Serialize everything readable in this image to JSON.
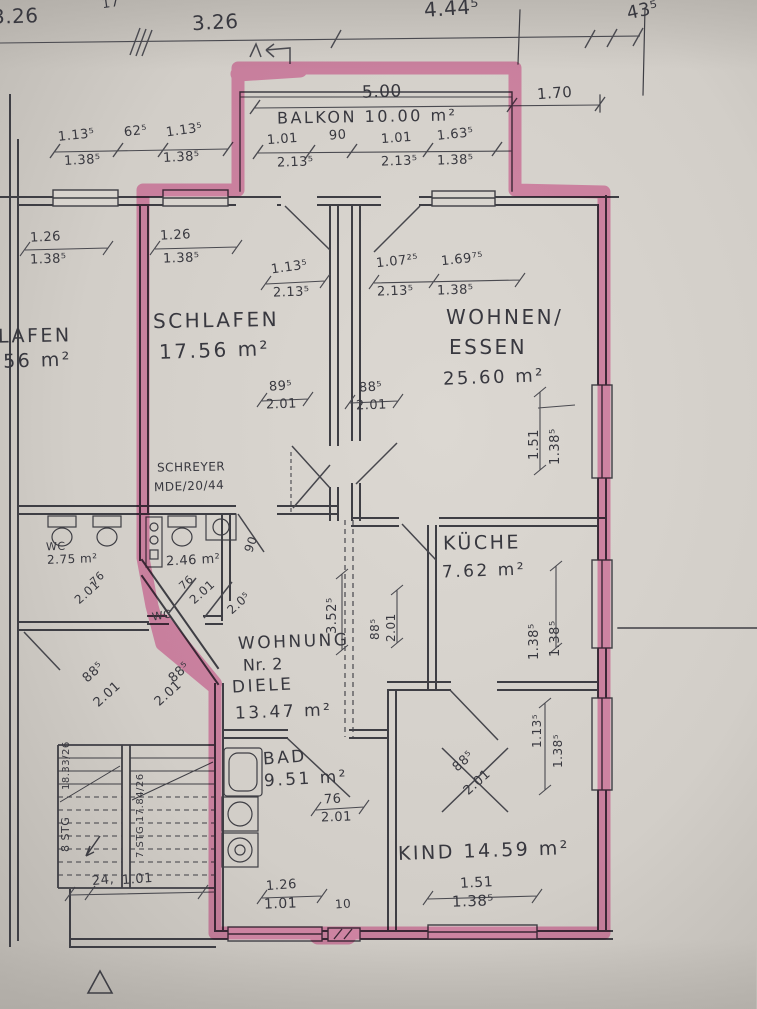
{
  "document": {
    "kind_label": "floor plan scan",
    "apartment_label": "WOHNUNG Nr. 2",
    "highlight_color": "#e8559f",
    "paper_color": "#d4d0ca",
    "ink_color": "#3e3e44"
  },
  "labels": [
    {
      "name": "dim-top-left-326",
      "text": "3.26",
      "x": -8,
      "y": 6,
      "size": 20,
      "rot": -2
    },
    {
      "name": "dim-top-17",
      "text": "17",
      "x": 102,
      "y": -3,
      "size": 13,
      "rot": -8
    },
    {
      "name": "dim-top-326",
      "text": "3.26",
      "x": 192,
      "y": 12,
      "size": 20,
      "rot": -3
    },
    {
      "name": "dim-top-4445",
      "text": "4.44⁵",
      "x": 424,
      "y": -2,
      "size": 20,
      "rot": -4
    },
    {
      "name": "dim-top-435",
      "text": "43⁵",
      "x": 627,
      "y": 2,
      "size": 18,
      "rot": -12
    },
    {
      "name": "dim-balkon-500",
      "text": "5.00",
      "x": 362,
      "y": 84,
      "size": 17,
      "rot": -2
    },
    {
      "name": "dim-170",
      "text": "1.70",
      "x": 537,
      "y": 86,
      "size": 15,
      "rot": -4
    },
    {
      "name": "room-balkon",
      "text": "BALKON 10.00 m²",
      "x": 277,
      "y": 109,
      "size": 16,
      "rot": -1,
      "cls": "big"
    },
    {
      "name": "dim-balkon-101a",
      "text": "1.01",
      "x": 267,
      "y": 133,
      "size": 13,
      "rot": -4
    },
    {
      "name": "dim-balkon-90",
      "text": "90",
      "x": 329,
      "y": 129,
      "size": 13,
      "rot": -4
    },
    {
      "name": "dim-balkon-101b",
      "text": "1.01",
      "x": 381,
      "y": 132,
      "size": 13,
      "rot": -4
    },
    {
      "name": "dim-balkon-1635",
      "text": "1.63⁵",
      "x": 437,
      "y": 128,
      "size": 13,
      "rot": -6
    },
    {
      "name": "dim-balkon-2135a",
      "text": "2.13⁵",
      "x": 277,
      "y": 156,
      "size": 13,
      "rot": -2
    },
    {
      "name": "dim-balkon-2135b",
      "text": "2.13⁵",
      "x": 381,
      "y": 155,
      "size": 13,
      "rot": -2
    },
    {
      "name": "dim-balkon-1385",
      "text": "1.38⁵",
      "x": 437,
      "y": 154,
      "size": 13,
      "rot": -2
    },
    {
      "name": "dim-nb-1135a",
      "text": "1.13⁵",
      "x": 58,
      "y": 129,
      "size": 13,
      "rot": -6
    },
    {
      "name": "dim-nb-625",
      "text": "62⁵",
      "x": 124,
      "y": 125,
      "size": 13,
      "rot": -6
    },
    {
      "name": "dim-nb-1135b",
      "text": "1.13⁵",
      "x": 166,
      "y": 124,
      "size": 13,
      "rot": -8
    },
    {
      "name": "dim-nb-1385a",
      "text": "1.38⁵",
      "x": 64,
      "y": 154,
      "size": 13,
      "rot": -3
    },
    {
      "name": "dim-nb-1385b",
      "text": "1.38⁵",
      "x": 163,
      "y": 151,
      "size": 13,
      "rot": -3
    },
    {
      "name": "dim-nbl-126",
      "text": "1.26",
      "x": 30,
      "y": 231,
      "size": 13,
      "rot": -3
    },
    {
      "name": "dim-nbl-1385",
      "text": "1.38⁵",
      "x": 30,
      "y": 253,
      "size": 13,
      "rot": -2
    },
    {
      "name": "dim-schlafen-126",
      "text": "1.26",
      "x": 160,
      "y": 229,
      "size": 13,
      "rot": -3
    },
    {
      "name": "dim-schlafen-1385",
      "text": "1.38⁵",
      "x": 163,
      "y": 252,
      "size": 13,
      "rot": -2
    },
    {
      "name": "dim-schlafen-1135",
      "text": "1.13⁵",
      "x": 271,
      "y": 261,
      "size": 13,
      "rot": -8
    },
    {
      "name": "dim-schlafen-2135",
      "text": "2.13⁵",
      "x": 273,
      "y": 286,
      "size": 13,
      "rot": -2
    },
    {
      "name": "room-schlafen-name",
      "text": "SCHLAFEN",
      "x": 153,
      "y": 310,
      "size": 20,
      "rot": -1,
      "cls": "big"
    },
    {
      "name": "room-schlafen-area",
      "text": "17.56 m²",
      "x": 159,
      "y": 340,
      "size": 20,
      "rot": -2,
      "cls": "big"
    },
    {
      "name": "dim-door-895",
      "text": "89⁵",
      "x": 269,
      "y": 380,
      "size": 13,
      "rot": -4
    },
    {
      "name": "dim-door-895-h",
      "text": "2.01",
      "x": 266,
      "y": 398,
      "size": 13,
      "rot": -2
    },
    {
      "name": "dim-door-885",
      "text": "88⁵",
      "x": 359,
      "y": 381,
      "size": 13,
      "rot": -4
    },
    {
      "name": "dim-door-885-h",
      "text": "2.01",
      "x": 356,
      "y": 399,
      "size": 13,
      "rot": -2
    },
    {
      "name": "dim-wohnen-10725",
      "text": "1.07²⁵",
      "x": 376,
      "y": 255,
      "size": 13,
      "rot": -6
    },
    {
      "name": "dim-wohnen-16975",
      "text": "1.69⁷⁵",
      "x": 441,
      "y": 253,
      "size": 13,
      "rot": -6
    },
    {
      "name": "dim-wohnen-2135",
      "text": "2.13⁵",
      "x": 377,
      "y": 285,
      "size": 13,
      "rot": -2
    },
    {
      "name": "dim-wohnen-1385",
      "text": "1.38⁵",
      "x": 437,
      "y": 284,
      "size": 13,
      "rot": -2
    },
    {
      "name": "room-wohnen-name-1",
      "text": "WOHNEN/",
      "x": 446,
      "y": 307,
      "size": 20,
      "rot": 0,
      "cls": "big"
    },
    {
      "name": "room-wohnen-name-2",
      "text": "ESSEN",
      "x": 449,
      "y": 337,
      "size": 20,
      "rot": 0,
      "cls": "big"
    },
    {
      "name": "room-wohnen-area",
      "text": "25.60 m²",
      "x": 443,
      "y": 369,
      "size": 18,
      "rot": -2,
      "cls": "big"
    },
    {
      "name": "dim-wohnen-151-v",
      "text": "1.51",
      "x": 528,
      "y": 460,
      "size": 13,
      "rot": -90
    },
    {
      "name": "dim-wohnen-1385-v",
      "text": "1.38⁵",
      "x": 549,
      "y": 465,
      "size": 13,
      "rot": -90
    },
    {
      "name": "note-schreyer",
      "text": "SCHREYER",
      "x": 157,
      "y": 461,
      "size": 12,
      "rot": -1
    },
    {
      "name": "note-ref",
      "text": "MDE/20/44",
      "x": 154,
      "y": 480,
      "size": 12,
      "rot": -2
    },
    {
      "name": "room-kueche-name",
      "text": "KÜCHE",
      "x": 443,
      "y": 534,
      "size": 19,
      "rot": -1,
      "cls": "big"
    },
    {
      "name": "room-kueche-area",
      "text": "7.62 m²",
      "x": 442,
      "y": 563,
      "size": 17,
      "rot": -2,
      "cls": "big"
    },
    {
      "name": "dim-kueche-1385a-v",
      "text": "1.38⁵",
      "x": 528,
      "y": 660,
      "size": 13,
      "rot": -90
    },
    {
      "name": "dim-kueche-1385b-v",
      "text": "1.38⁵",
      "x": 549,
      "y": 657,
      "size": 13,
      "rot": -90
    },
    {
      "name": "dim-hall-3525-v",
      "text": "3.52⁵",
      "x": 326,
      "y": 634,
      "size": 13,
      "rot": -90
    },
    {
      "name": "dim-hall-885-v",
      "text": "88⁵",
      "x": 369,
      "y": 640,
      "size": 12,
      "rot": -90
    },
    {
      "name": "dim-hall-201-v",
      "text": "2.01",
      "x": 385,
      "y": 642,
      "size": 12,
      "rot": -90
    },
    {
      "name": "dim-door-90",
      "text": "90",
      "x": 243,
      "y": 538,
      "size": 12,
      "rot": -70
    },
    {
      "name": "label-wc-neighbor",
      "text": "WC",
      "x": 46,
      "y": 541,
      "size": 11,
      "rot": -2
    },
    {
      "name": "area-wc-neighbor",
      "text": "2.75 m²",
      "x": 47,
      "y": 553,
      "size": 12,
      "rot": -2
    },
    {
      "name": "dim-wcnb-76",
      "text": "76",
      "x": 90,
      "y": 573,
      "size": 11,
      "rot": -42
    },
    {
      "name": "dim-wcnb-201",
      "text": "2.01",
      "x": 73,
      "y": 586,
      "size": 12,
      "rot": -42
    },
    {
      "name": "area-wc-apartment",
      "text": "2.46 m²",
      "x": 166,
      "y": 554,
      "size": 13,
      "rot": -3
    },
    {
      "name": "dim-wcap-76",
      "text": "76",
      "x": 179,
      "y": 577,
      "size": 11,
      "rot": -42
    },
    {
      "name": "dim-wcap-201",
      "text": "2.01",
      "x": 188,
      "y": 586,
      "size": 12,
      "rot": -42
    },
    {
      "name": "dim-wcap-205",
      "text": "2.0⁵",
      "x": 226,
      "y": 597,
      "size": 12,
      "rot": -42
    },
    {
      "name": "label-wc-apartment",
      "text": "WC",
      "x": 152,
      "y": 610,
      "size": 11,
      "rot": -10
    },
    {
      "name": "label-wohnung-1",
      "text": "WOHNUNG",
      "x": 238,
      "y": 634,
      "size": 17,
      "rot": -2,
      "cls": "big"
    },
    {
      "name": "label-wohnung-2",
      "text": "Nr. 2",
      "x": 243,
      "y": 657,
      "size": 16,
      "rot": -2
    },
    {
      "name": "dim-diele-885",
      "text": "88⁵",
      "x": 168,
      "y": 666,
      "size": 13,
      "rot": -42
    },
    {
      "name": "dim-diele-201",
      "text": "2.01",
      "x": 153,
      "y": 687,
      "size": 13,
      "rot": -42
    },
    {
      "name": "room-diele-name",
      "text": "DIELE",
      "x": 232,
      "y": 678,
      "size": 17,
      "rot": -3,
      "cls": "big"
    },
    {
      "name": "room-diele-area",
      "text": "13.47 m²",
      "x": 235,
      "y": 704,
      "size": 17,
      "rot": -2,
      "cls": "big"
    },
    {
      "name": "dim-stair-885",
      "text": "88⁵",
      "x": 82,
      "y": 666,
      "size": 13,
      "rot": -42
    },
    {
      "name": "dim-stair-201",
      "text": "2.01",
      "x": 92,
      "y": 688,
      "size": 13,
      "rot": -42
    },
    {
      "name": "stair-left-steigung",
      "text": "18.33/26",
      "x": 62,
      "y": 790,
      "size": 10,
      "rot": -90
    },
    {
      "name": "stair-left-stg",
      "text": "8 STG",
      "x": 60,
      "y": 852,
      "size": 11,
      "rot": -90
    },
    {
      "name": "stair-right-stg",
      "text": "7 STG 17.84/26",
      "x": 136,
      "y": 858,
      "size": 10,
      "rot": -90
    },
    {
      "name": "dim-24",
      "text": "24,",
      "x": 92,
      "y": 874,
      "size": 13,
      "rot": -6
    },
    {
      "name": "dim-101-stair",
      "text": "1.01",
      "x": 122,
      "y": 873,
      "size": 13,
      "rot": -4
    },
    {
      "name": "room-bad-name",
      "text": "BAD",
      "x": 263,
      "y": 750,
      "size": 17,
      "rot": -4,
      "cls": "big"
    },
    {
      "name": "room-bad-area",
      "text": "9.51 m²",
      "x": 264,
      "y": 771,
      "size": 17,
      "rot": -3,
      "cls": "big"
    },
    {
      "name": "dim-bad-76",
      "text": "76",
      "x": 324,
      "y": 793,
      "size": 13,
      "rot": -3
    },
    {
      "name": "dim-bad-201",
      "text": "2.01",
      "x": 321,
      "y": 811,
      "size": 13,
      "rot": -2
    },
    {
      "name": "dim-kind-885",
      "text": "88⁵",
      "x": 452,
      "y": 755,
      "size": 13,
      "rot": -42
    },
    {
      "name": "dim-kind-201",
      "text": "2.01",
      "x": 462,
      "y": 776,
      "size": 13,
      "rot": -42
    },
    {
      "name": "room-kind-name",
      "text": "KIND 14.59 m²",
      "x": 398,
      "y": 842,
      "size": 19,
      "rot": -2,
      "cls": "big"
    },
    {
      "name": "dim-kind-151",
      "text": "1.51",
      "x": 460,
      "y": 876,
      "size": 14,
      "rot": -3
    },
    {
      "name": "dim-kind-1385",
      "text": "1.38⁵",
      "x": 452,
      "y": 894,
      "size": 15,
      "rot": -2
    },
    {
      "name": "dim-kind-1135-v",
      "text": "1.13⁵",
      "x": 531,
      "y": 748,
      "size": 12,
      "rot": -90
    },
    {
      "name": "dim-kind-1385-v",
      "text": "1.38⁵",
      "x": 552,
      "y": 768,
      "size": 12,
      "rot": -90
    },
    {
      "name": "dim-bottom-126",
      "text": "1.26",
      "x": 266,
      "y": 879,
      "size": 13,
      "rot": -4
    },
    {
      "name": "dim-bottom-101",
      "text": "1.01",
      "x": 264,
      "y": 897,
      "size": 14,
      "rot": -2
    },
    {
      "name": "dim-bottom-10",
      "text": "10",
      "x": 335,
      "y": 898,
      "size": 12,
      "rot": -4
    },
    {
      "name": "room-cut-lafen",
      "text": "LAFEN",
      "x": -2,
      "y": 327,
      "size": 19,
      "rot": -1,
      "cls": "big"
    },
    {
      "name": "room-cut-area",
      "text": "7.56 m²",
      "x": -20,
      "y": 352,
      "size": 19,
      "rot": -2,
      "cls": "big"
    }
  ]
}
